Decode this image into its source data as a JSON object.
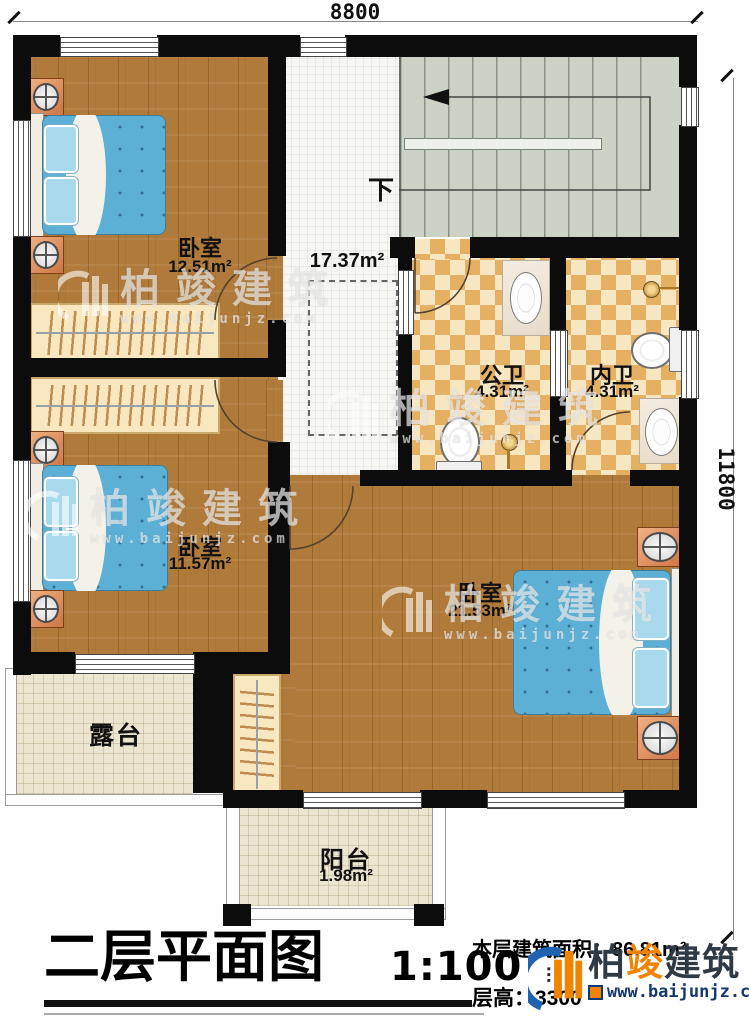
{
  "dimensions": {
    "width_mm": "8800",
    "height_mm": "11800"
  },
  "rooms": {
    "bedroom_top_left": {
      "label": "卧室",
      "area": "12.51m²"
    },
    "bedroom_mid_left": {
      "label": "卧室",
      "area": "11.57m²"
    },
    "bedroom_master": {
      "label": "卧室",
      "area": "21.53m²"
    },
    "hallway": {
      "area": "17.37m²"
    },
    "public_bath": {
      "label": "公卫",
      "area": "4.31m²"
    },
    "ensuite_bath": {
      "label": "内卫",
      "area": "4.31m²"
    },
    "terrace": {
      "label": "露台"
    },
    "balcony": {
      "label": "阳台",
      "area": "1.98m²"
    }
  },
  "stairs": {
    "direction_label": "下"
  },
  "title_block": {
    "title": "二层平面图",
    "scale": "1:100",
    "floor_area": "本层建筑面积：86.81m²",
    "floor_height_label": "层高：",
    "floor_height_value": "3300"
  },
  "branding": {
    "logo_chars": [
      "柏",
      "竣",
      "建",
      "筑"
    ],
    "website": "www.baijunjz.com"
  },
  "watermark": {
    "text": "柏竣建筑",
    "url": "www.baijunjz.com"
  },
  "colors": {
    "wall": "#0c0c0c",
    "wood_floor": "#b07a3a",
    "bath_tile": "#e6b063",
    "stair_floor": "#ccd3c6",
    "bed_blue": "#5cb0d6",
    "accent_orange": "#f08300",
    "brand_navy": "#15386e"
  }
}
